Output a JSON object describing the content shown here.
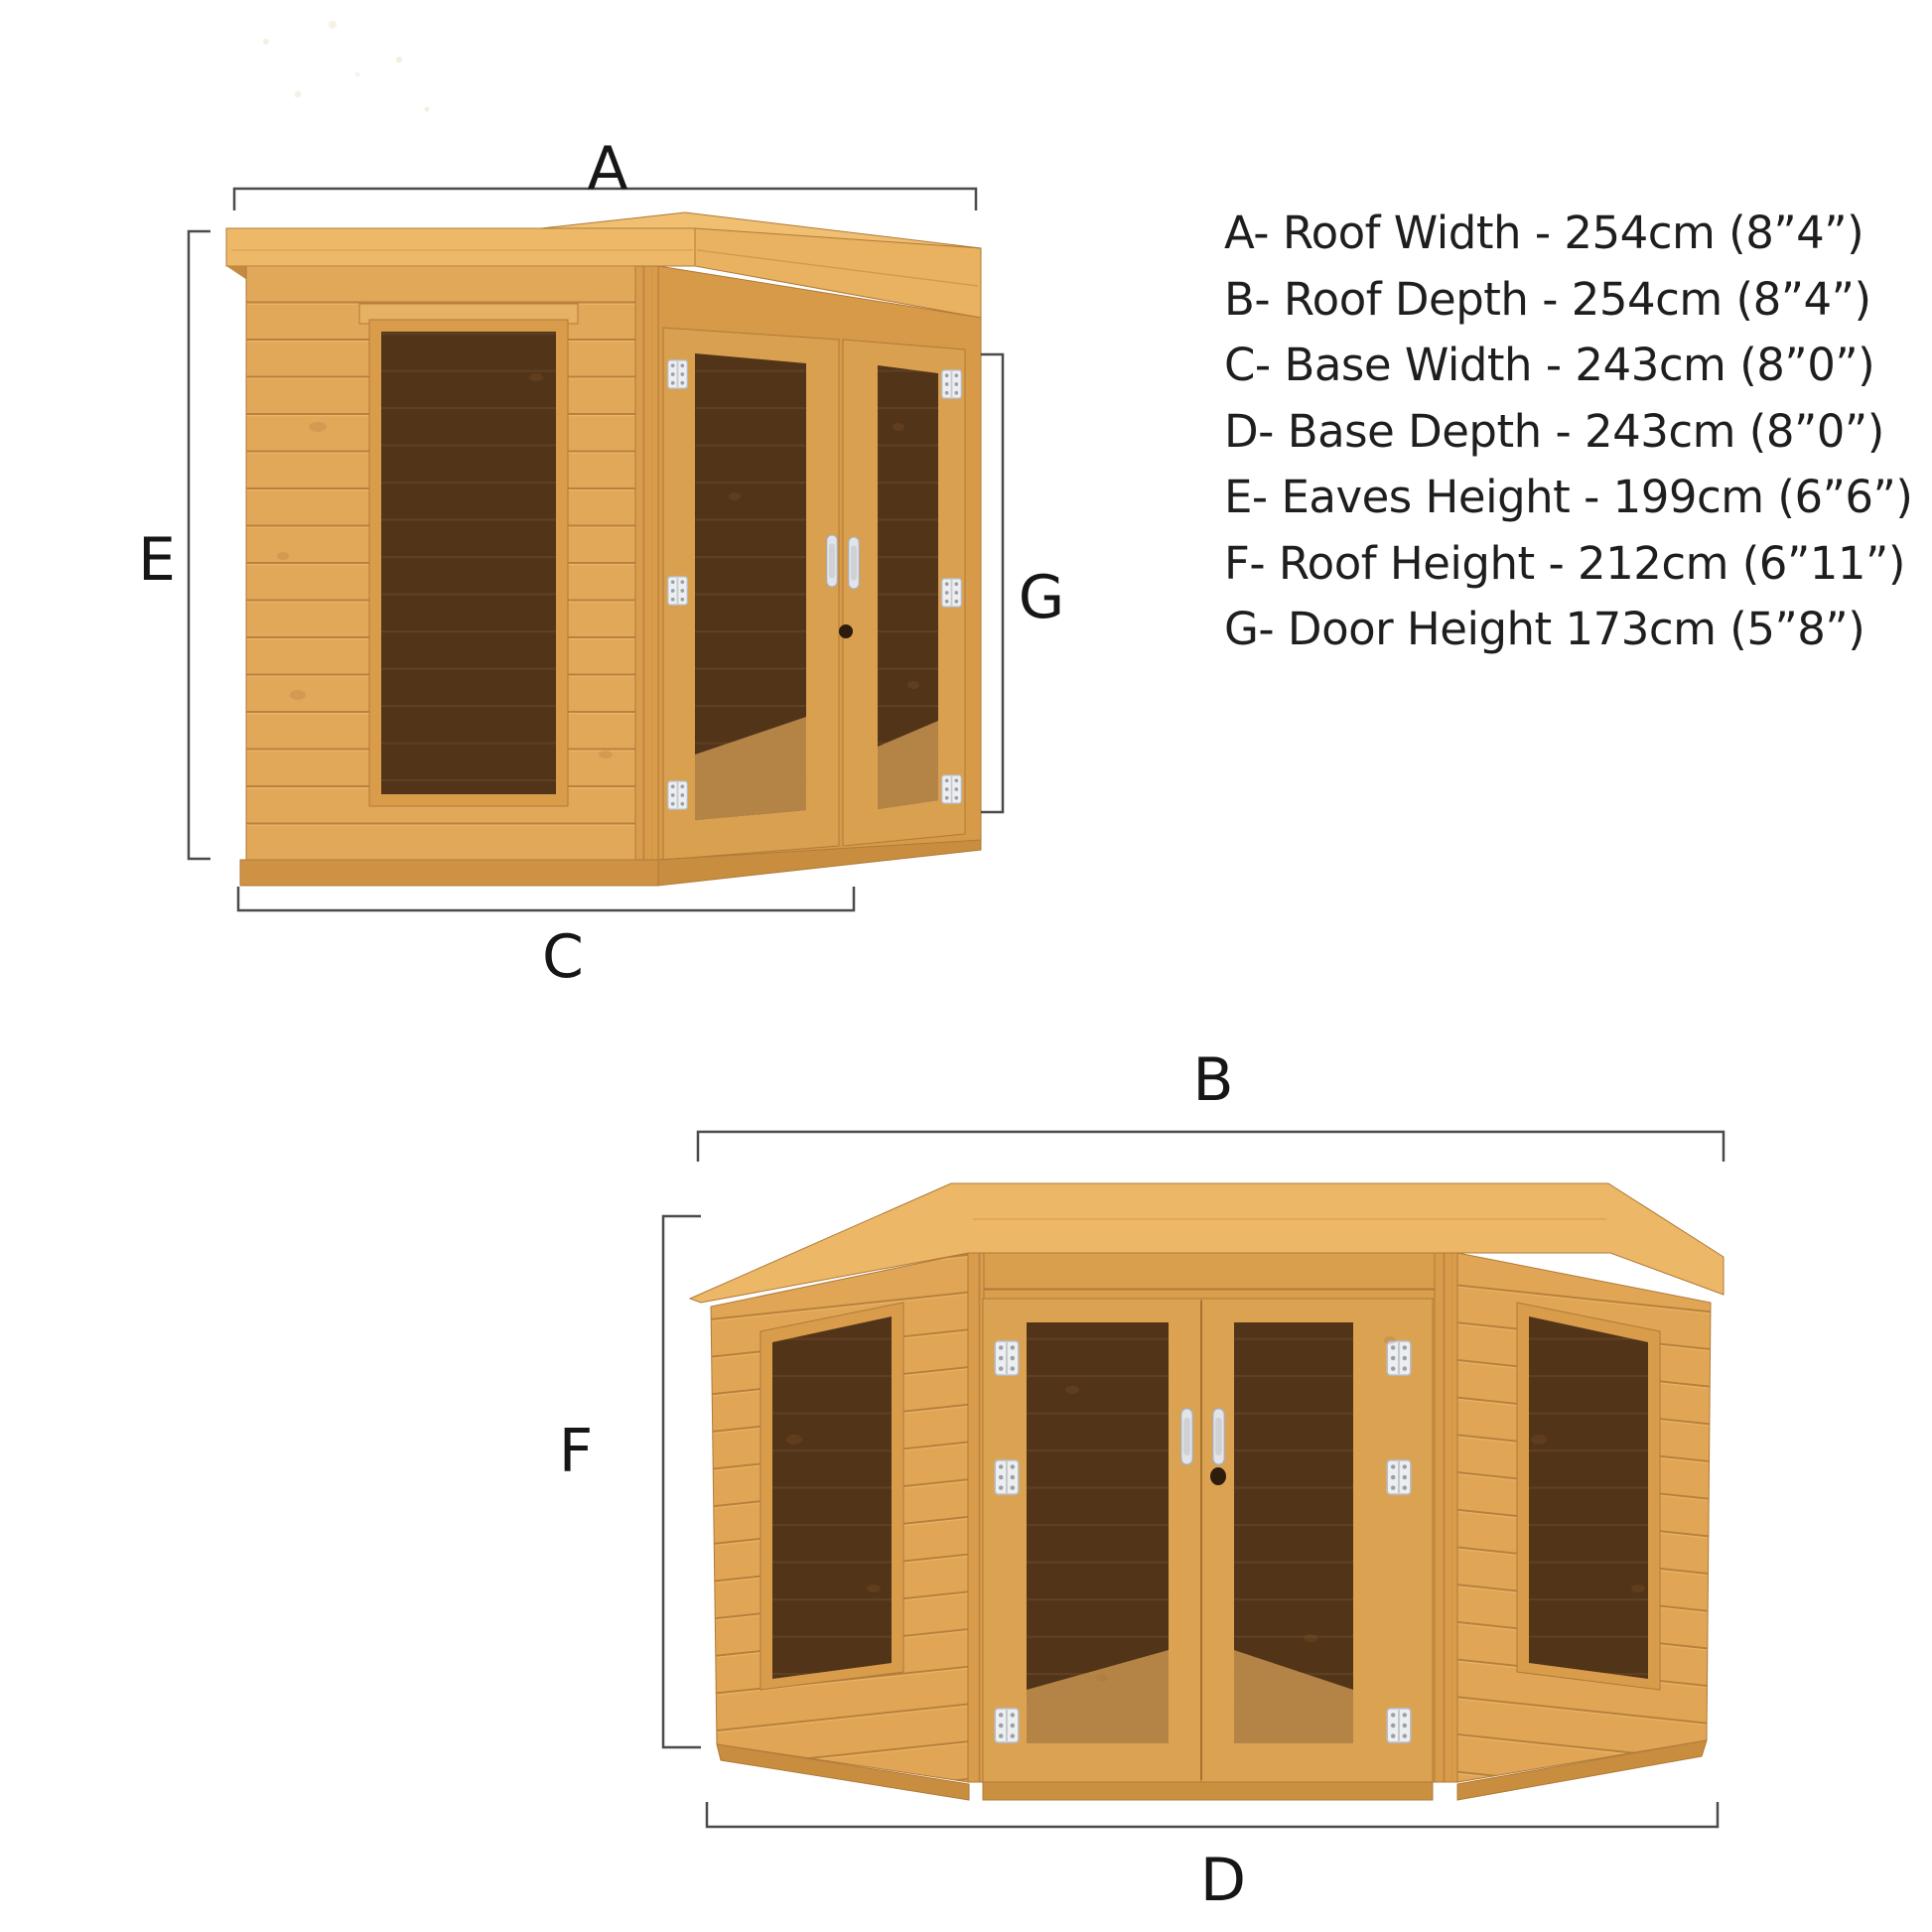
{
  "page": {
    "background": "#ffffff",
    "title": "Corner summerhouse dimensions diagram"
  },
  "diagram": {
    "spec_list": {
      "items": [
        {
          "letter": "A",
          "name": "Roof Width",
          "metric": "254cm",
          "imperial": "8”4”",
          "text": "A- Roof Width - 254cm (8”4”)"
        },
        {
          "letter": "B",
          "name": "Roof Depth",
          "metric": "254cm",
          "imperial": "8”4”",
          "text": "B- Roof Depth - 254cm (8”4”)"
        },
        {
          "letter": "C",
          "name": "Base Width",
          "metric": "243cm",
          "imperial": "8”0”",
          "text": "C- Base Width - 243cm (8”0”)"
        },
        {
          "letter": "D",
          "name": "Base Depth",
          "metric": "243cm",
          "imperial": "8”0”",
          "text": "D- Base Depth - 243cm (8”0”)"
        },
        {
          "letter": "E",
          "name": "Eaves Height",
          "metric": "199cm",
          "imperial": "6”6”",
          "text": "E- Eaves Height - 199cm (6”6”)"
        },
        {
          "letter": "F",
          "name": "Roof Height",
          "metric": "212cm",
          "imperial": "6”11”",
          "text": "F- Roof Height - 212cm (6”11”)"
        },
        {
          "letter": "G",
          "name": "Door Height",
          "metric": "173cm",
          "imperial": "5”8”",
          "text": "G- Door Height 173cm (5”8”)"
        }
      ]
    },
    "side_view": {
      "labels": {
        "roof_width": "A",
        "eaves_height": "E",
        "door_height": "G",
        "base_width": "C"
      }
    },
    "front_view": {
      "labels": {
        "roof_depth": "B",
        "roof_height": "F",
        "base_depth": "D"
      }
    }
  },
  "colors": {
    "wood_light": "#e2a85a",
    "wood_mid": "#d9a050",
    "wood_roof": "#edb968",
    "plank_gap": "#bb813c",
    "glass_dark": "#523419",
    "glass_stripe": "#604023",
    "floor": "#b9894a",
    "hinge": "#edeef0",
    "handle": "#e3e4e7",
    "dimension_line": "#4b4b4b",
    "label_text": "#161616",
    "spec_text": "#1e1e1e"
  }
}
